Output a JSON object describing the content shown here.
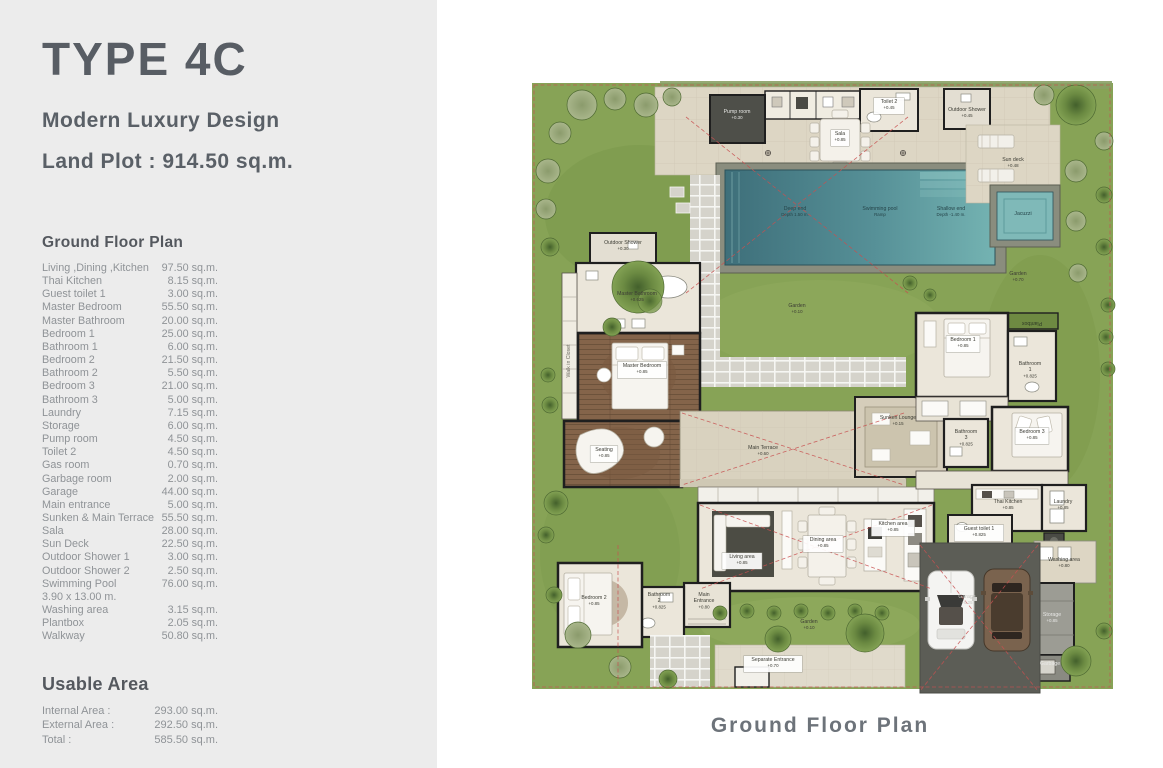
{
  "panel": {
    "title": "TYPE 4C",
    "subtitle": "Modern Luxury Design",
    "land_plot": "Land Plot : 914.50 sq.m.",
    "section_title": "Ground Floor Plan",
    "rooms": [
      {
        "label": "Living ,Dining ,Kitchen",
        "value": "97.50 sq.m."
      },
      {
        "label": "Thai Kitchen",
        "value": "8.15 sq.m."
      },
      {
        "label": "Guest toilet 1",
        "value": "3.00 sq.m."
      },
      {
        "label": "Master Bedroom",
        "value": "55.50 sq.m."
      },
      {
        "label": "Master Bathroom",
        "value": "20.00 sq.m."
      },
      {
        "label": "Bedroom 1",
        "value": "25.00 sq.m."
      },
      {
        "label": "Bathroom 1",
        "value": "6.00 sq.m."
      },
      {
        "label": "Bedroom 2",
        "value": "21.50 sq.m."
      },
      {
        "label": "Bathroom 2",
        "value": "5.50 sq.m."
      },
      {
        "label": "Bedroom 3",
        "value": "21.00 sq.m."
      },
      {
        "label": "Bathroom 3",
        "value": "5.00 sq.m."
      },
      {
        "label": "Laundry",
        "value": "7.15 sq.m."
      },
      {
        "label": "Storage",
        "value": "6.00 sq.m."
      },
      {
        "label": "Pump room",
        "value": "4.50 sq.m."
      },
      {
        "label": "Toilet 2",
        "value": "4.50 sq.m."
      },
      {
        "label": "Gas room",
        "value": "0.70 sq.m."
      },
      {
        "label": "Garbage room",
        "value": "2.00 sq.m."
      },
      {
        "label": "Garage",
        "value": "44.00 sq.m."
      },
      {
        "label": "Main entrance",
        "value": "5.00 sq.m."
      },
      {
        "label": "Sunken & Main Terrace",
        "value": "55.50 sq.m."
      },
      {
        "label": "Sala",
        "value": "28.00 sq.m."
      },
      {
        "label": "Sun Deck",
        "value": "22.50 sq.m."
      },
      {
        "label": "Outdoor Shower 1",
        "value": "3.00 sq.m."
      },
      {
        "label": "Outdoor Shower 2",
        "value": "2.50 sq.m."
      },
      {
        "label": "Swimming Pool",
        "value": "76.00 sq.m."
      },
      {
        "label": "3.90 x 13.00 m.",
        "value": ""
      },
      {
        "label": "Washing area",
        "value": "3.15 sq.m."
      },
      {
        "label": "Plantbox",
        "value": "2.05 sq.m."
      },
      {
        "label": "Walkway",
        "value": "50.80 sq.m."
      }
    ],
    "usable": {
      "title": "Usable Area",
      "rows": [
        {
          "label": "Internal Area :",
          "value": "293.00 sq.m."
        },
        {
          "label": "External Area :",
          "value": "292.50 sq.m."
        },
        {
          "label": "Total :",
          "value": "585.50 sq.m."
        }
      ]
    }
  },
  "plan": {
    "caption": "Ground Floor Plan",
    "colors": {
      "grass": "#87a356",
      "pool_deep": "#3e6f7a",
      "pool_shallow": "#74b3b2",
      "terrace": "#ddd6c4",
      "wood_floor": "#84644a",
      "driveway": "#5c5d56",
      "boundary_red": "#c85050",
      "panel_bg": "#ececec",
      "title_text": "#585d64"
    },
    "labels": [
      {
        "x": 217,
        "y": 38,
        "lines": [
          "Pump room"
        ],
        "sub": "+0.30",
        "color": "#e8e8e6"
      },
      {
        "x": 320,
        "y": 60,
        "lines": [
          "Sala"
        ],
        "sub": "+0.85",
        "box": true
      },
      {
        "x": 369,
        "y": 28,
        "lines": [
          "Toilet 2"
        ],
        "sub": "+0.45",
        "box": true
      },
      {
        "x": 447,
        "y": 36,
        "lines": [
          "Outdoor Shower"
        ],
        "sub": "+0.45"
      },
      {
        "x": 493,
        "y": 86,
        "lines": [
          "Sun deck"
        ],
        "sub": "+0.48"
      },
      {
        "x": 275,
        "y": 135,
        "lines": [
          "Deep end"
        ],
        "sub": "Depth  1.50 m.",
        "color": "#26454a"
      },
      {
        "x": 360,
        "y": 135,
        "lines": [
          "Swimming pool"
        ],
        "sub": "Ramp",
        "color": "#26454a"
      },
      {
        "x": 431,
        "y": 135,
        "lines": [
          "Shallow end"
        ],
        "sub": "Depth  -1.40 m.",
        "color": "#26454a"
      },
      {
        "x": 503,
        "y": 140,
        "lines": [
          "Jacuzzi"
        ],
        "color": "#26454a"
      },
      {
        "x": 498,
        "y": 200,
        "lines": [
          "Garden"
        ],
        "sub": "+0.70"
      },
      {
        "x": 277,
        "y": 232,
        "lines": [
          "Garden"
        ],
        "sub": "+0.10"
      },
      {
        "x": 103,
        "y": 169,
        "lines": [
          "Outdoor Shower"
        ],
        "sub": "+0.30"
      },
      {
        "x": 117,
        "y": 220,
        "lines": [
          "Master Bathroom"
        ],
        "sub": "+0.625"
      },
      {
        "x": 122,
        "y": 292,
        "lines": [
          "Master Bedroom"
        ],
        "sub": "+0.85",
        "box": true
      },
      {
        "x": 84,
        "y": 376,
        "lines": [
          "Seating"
        ],
        "sub": "+0.85",
        "box": true
      },
      {
        "x": 243,
        "y": 374,
        "lines": [
          "Main Terrace"
        ],
        "sub": "+0.60"
      },
      {
        "x": 378,
        "y": 344,
        "lines": [
          "Sunken Lounge"
        ],
        "sub": "+0.15"
      },
      {
        "x": 443,
        "y": 266,
        "lines": [
          "Bedroom 1"
        ],
        "sub": "+0.85",
        "box": true
      },
      {
        "x": 510,
        "y": 290,
        "lines": [
          "Bathroom",
          "1"
        ],
        "sub": "+0.825"
      },
      {
        "x": 446,
        "y": 358,
        "lines": [
          "Bathroom",
          "3"
        ],
        "sub": "+0.825"
      },
      {
        "x": 512,
        "y": 358,
        "lines": [
          "Bedroom 3"
        ],
        "sub": "+0.85",
        "box": true
      },
      {
        "x": 488,
        "y": 428,
        "lines": [
          "Thai Kitchen"
        ],
        "sub": "+0.85"
      },
      {
        "x": 543,
        "y": 428,
        "lines": [
          "Laundry"
        ],
        "sub": "+0.85"
      },
      {
        "x": 222,
        "y": 483,
        "lines": [
          "Living area"
        ],
        "sub": "+0.85",
        "box": true
      },
      {
        "x": 303,
        "y": 466,
        "lines": [
          "Dining area"
        ],
        "sub": "+0.85",
        "box": true
      },
      {
        "x": 373,
        "y": 450,
        "lines": [
          "Kitchen area"
        ],
        "sub": "+0.85",
        "box": true
      },
      {
        "x": 184,
        "y": 521,
        "lines": [
          "Main",
          "Entrance"
        ],
        "sub": "+0.80"
      },
      {
        "x": 139,
        "y": 521,
        "lines": [
          "Bathroom",
          "2"
        ],
        "sub": "+0.825"
      },
      {
        "x": 74,
        "y": 524,
        "lines": [
          "Bedroom 2"
        ],
        "sub": "+0.85"
      },
      {
        "x": 459,
        "y": 455,
        "lines": [
          "Guest toilet 1"
        ],
        "sub": "+0.825",
        "box": true
      },
      {
        "x": 544,
        "y": 486,
        "lines": [
          "Washing area"
        ],
        "sub": "+0.80"
      },
      {
        "x": 532,
        "y": 541,
        "lines": [
          "Storage"
        ],
        "sub": "+0.85",
        "color": "#e8e8e6"
      },
      {
        "x": 530,
        "y": 590,
        "lines": [
          "Garbage"
        ],
        "color": "#e8e8e6"
      },
      {
        "x": 447,
        "y": 523,
        "lines": [
          "Garage"
        ],
        "sub": "+0.25",
        "color": "#c6c6c2"
      },
      {
        "x": 253,
        "y": 586,
        "lines": [
          "Separate Entrance"
        ],
        "sub": "+0.70",
        "box": true
      },
      {
        "x": 289,
        "y": 548,
        "lines": [
          "Garden"
        ],
        "sub": "+0.10"
      },
      {
        "x": 50,
        "y": 286,
        "lines": [
          "Walk in Closet"
        ],
        "rotate": -90,
        "color": "#6a6a60"
      },
      {
        "x": 512,
        "y": 247,
        "lines": [
          "Plantbox"
        ],
        "rotate": 180,
        "color": "#2f3a26"
      }
    ]
  }
}
